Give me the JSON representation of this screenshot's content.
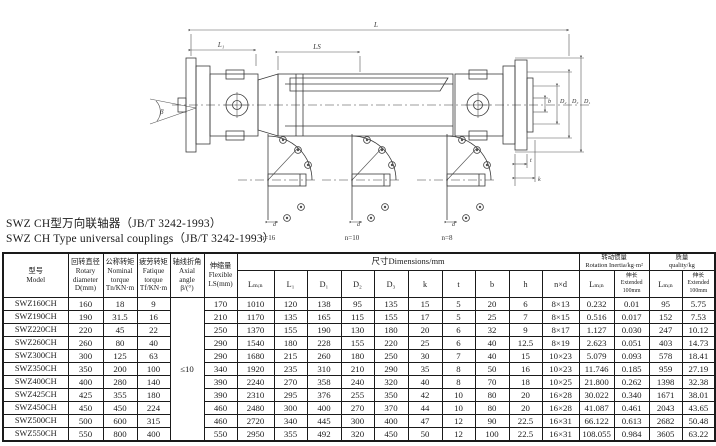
{
  "titles": {
    "line1_zh": "SWZ CH型万向联轴器（JB/T 3242-1993）",
    "line2_en": "SWZ CH Type universal couplings（JB/T 3242-1993）"
  },
  "drawing": {
    "labels": {
      "overall_length": "L",
      "left_length": "L₁",
      "slide": "LS",
      "angle": "β",
      "dim_b": "b",
      "dim_d2": "D₂",
      "dim_d3": "D₃",
      "dim_d1": "D₁",
      "dim_t": "t",
      "dim_k": "k",
      "dim_d": "d"
    },
    "details": [
      {
        "label": "n=16"
      },
      {
        "label": "n=10"
      },
      {
        "label": "n=8"
      }
    ]
  },
  "table": {
    "header": {
      "model": "型号\nModel",
      "rotary": "回转直径\nRotary\ndiameter\nD(mm)",
      "nominal": "公称转矩\nNominal\ntorque\nTn/KN·m",
      "fatigue": "疲劳转矩\nFatique\ntorque\nTf/KN·m",
      "axial": "轴线折角\nAxial angle\nβ/(°)",
      "flexible": "伸缩量\nFlexible\nLS(mm)",
      "dims_group": "尺寸Dimensions/mm",
      "inertia_group": "转动惯量\nRotation Inertia/kg·m²",
      "quality_group": "质量\nquality/kg",
      "dim_cols": [
        "Lₘᵢₙ",
        "L₁",
        "D₁",
        "D₂",
        "D₃",
        "k",
        "t",
        "b",
        "h",
        "n×d"
      ],
      "inertia_cols": [
        "Lₘᵢₙ",
        "伸长\nExtended\n100mm"
      ],
      "quality_cols": [
        "Lₘᵢₙ",
        "伸长\nExtended\n100mm"
      ]
    },
    "axial_value": "≤10",
    "rows": [
      [
        "SWZ160CH",
        "160",
        "18",
        "9",
        "170",
        "1010",
        "120",
        "138",
        "95",
        "135",
        "15",
        "5",
        "20",
        "6",
        "8×13",
        "0.232",
        "0.01",
        "95",
        "5.75"
      ],
      [
        "SWZ190CH",
        "190",
        "31.5",
        "16",
        "210",
        "1170",
        "135",
        "165",
        "115",
        "155",
        "17",
        "5",
        "25",
        "7",
        "8×15",
        "0.516",
        "0.017",
        "152",
        "7.53"
      ],
      [
        "SWZ220CH",
        "220",
        "45",
        "22",
        "250",
        "1370",
        "155",
        "190",
        "130",
        "180",
        "20",
        "6",
        "32",
        "9",
        "8×17",
        "1.127",
        "0.030",
        "247",
        "10.12"
      ],
      [
        "SWZ260CH",
        "260",
        "80",
        "40",
        "290",
        "1540",
        "180",
        "228",
        "155",
        "220",
        "25",
        "6",
        "40",
        "12.5",
        "8×19",
        "2.623",
        "0.051",
        "403",
        "14.73"
      ],
      [
        "SWZ300CH",
        "300",
        "125",
        "63",
        "290",
        "1680",
        "215",
        "260",
        "180",
        "250",
        "30",
        "7",
        "40",
        "15",
        "10×23",
        "5.079",
        "0.093",
        "578",
        "18.41"
      ],
      [
        "SWZ350CH",
        "350",
        "200",
        "100",
        "340",
        "1920",
        "235",
        "310",
        "210",
        "290",
        "35",
        "8",
        "50",
        "16",
        "10×23",
        "11.746",
        "0.185",
        "959",
        "27.19"
      ],
      [
        "SWZ400CH",
        "400",
        "280",
        "140",
        "390",
        "2240",
        "270",
        "358",
        "240",
        "320",
        "40",
        "8",
        "70",
        "18",
        "10×25",
        "21.800",
        "0.262",
        "1398",
        "32.38"
      ],
      [
        "SWZ425CH",
        "425",
        "355",
        "180",
        "390",
        "2310",
        "295",
        "376",
        "255",
        "350",
        "42",
        "10",
        "80",
        "20",
        "16×28",
        "30.022",
        "0.340",
        "1671",
        "38.01"
      ],
      [
        "SWZ450CH",
        "450",
        "450",
        "224",
        "460",
        "2480",
        "300",
        "400",
        "270",
        "370",
        "44",
        "10",
        "80",
        "20",
        "16×28",
        "41.087",
        "0.461",
        "2043",
        "43.65"
      ],
      [
        "SWZ500CH",
        "500",
        "600",
        "315",
        "460",
        "2720",
        "340",
        "445",
        "300",
        "400",
        "47",
        "12",
        "90",
        "22.5",
        "16×31",
        "66.122",
        "0.613",
        "2682",
        "50.48"
      ],
      [
        "SWZ550CH",
        "550",
        "800",
        "400",
        "550",
        "2950",
        "355",
        "492",
        "320",
        "450",
        "50",
        "12",
        "100",
        "22.5",
        "16×31",
        "108.055",
        "0.984",
        "3605",
        "63.22"
      ]
    ]
  }
}
